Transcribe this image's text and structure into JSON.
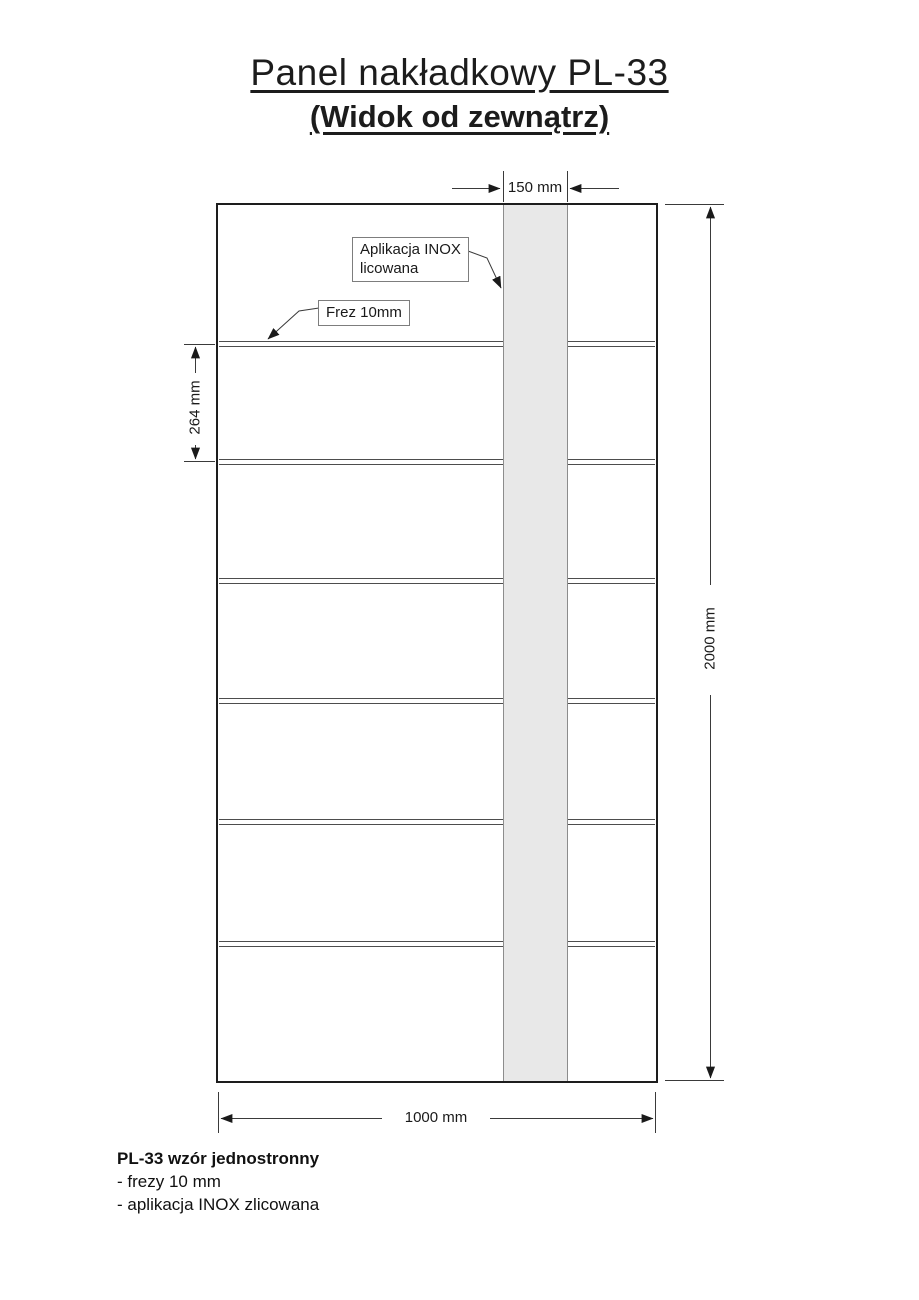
{
  "page": {
    "title": "Panel nakładkowy PL-33",
    "subtitle": "(Widok od zewnątrz)"
  },
  "callouts": {
    "inox": {
      "line1": "Aplikacja INOX",
      "line2": "licowana"
    },
    "frez": {
      "label": "Frez 10mm"
    }
  },
  "dimensions": {
    "stripe_width": "150 mm",
    "groove_pitch": "264 mm",
    "panel_height": "2000 mm",
    "panel_width": "1000 mm"
  },
  "notes": {
    "heading": "PL-33 wzór jednostronny",
    "items": [
      "- frezy 10 mm",
      "- aplikacja INOX zlicowana"
    ]
  },
  "colors": {
    "stripe_fill": "#e8e8e8",
    "panel_border": "#1d1d1d",
    "groove_line": "#4d4d4d",
    "dimension_line": "#3a3a3a"
  }
}
